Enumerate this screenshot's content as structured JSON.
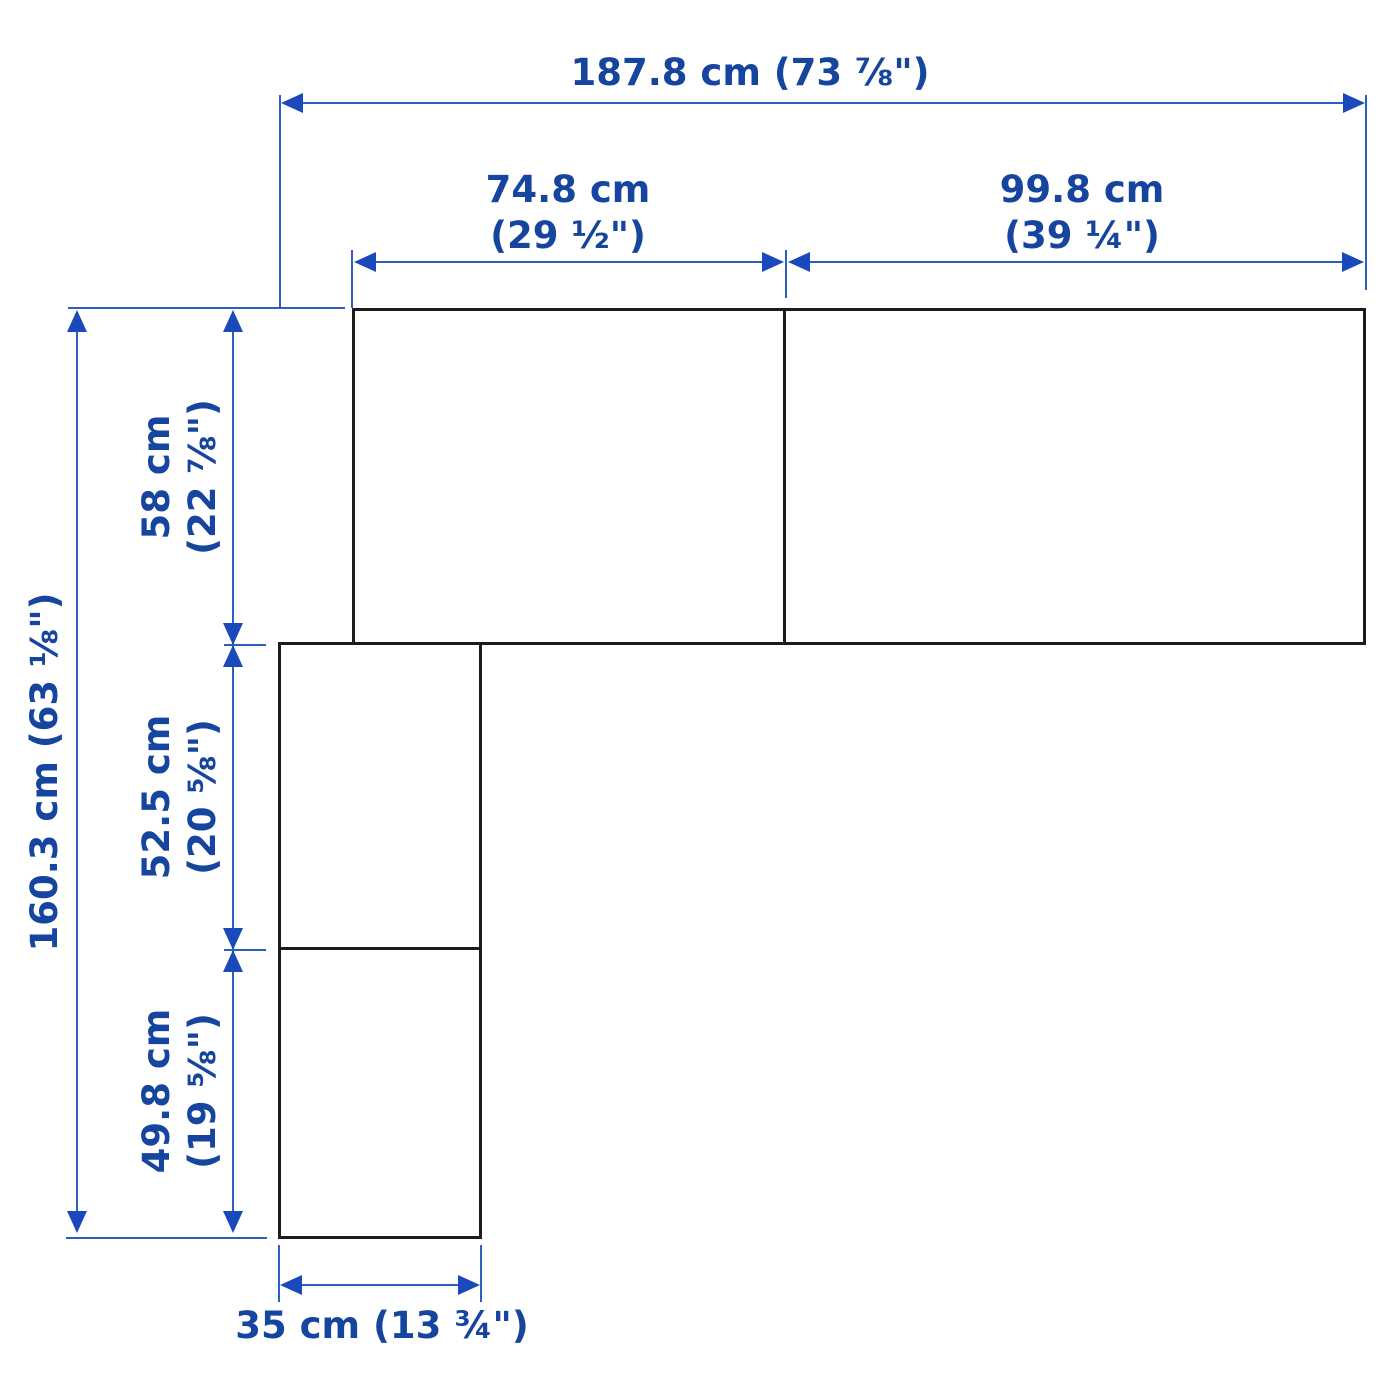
{
  "figure": {
    "type": "dimension-diagram",
    "description": "Corner furniture combination with width and height measurements"
  },
  "colors": {
    "background": "#ffffff",
    "outline": "#1c1c1c",
    "dimension_line": "#2b5fc0",
    "arrow": "#1a49bb",
    "dimension_text": "#16459f"
  },
  "dimensions": {
    "total_width": {
      "label": "187.8 cm (73 ⅞\")",
      "cm": 187.8
    },
    "top_left_width": {
      "line1": "74.8 cm",
      "line2": "(29 ½\")",
      "cm": 74.8
    },
    "top_right_width": {
      "line1": "99.8 cm",
      "line2": "(39 ¼\")",
      "cm": 99.8
    },
    "total_height": {
      "label": "160.3 cm (63 ⅛\")",
      "cm": 160.3
    },
    "upper_height": {
      "line1": "58 cm",
      "line2": "(22 ⅞\")",
      "cm": 58
    },
    "middle_height": {
      "line1": "52.5 cm",
      "line2": "(20 ⅝\")",
      "cm": 52.5
    },
    "lower_height": {
      "line1": "49.8 cm",
      "line2": "(19 ⅝\")",
      "cm": 49.8
    },
    "column_width": {
      "label": "35 cm (13 ¾\")",
      "cm": 35
    }
  }
}
